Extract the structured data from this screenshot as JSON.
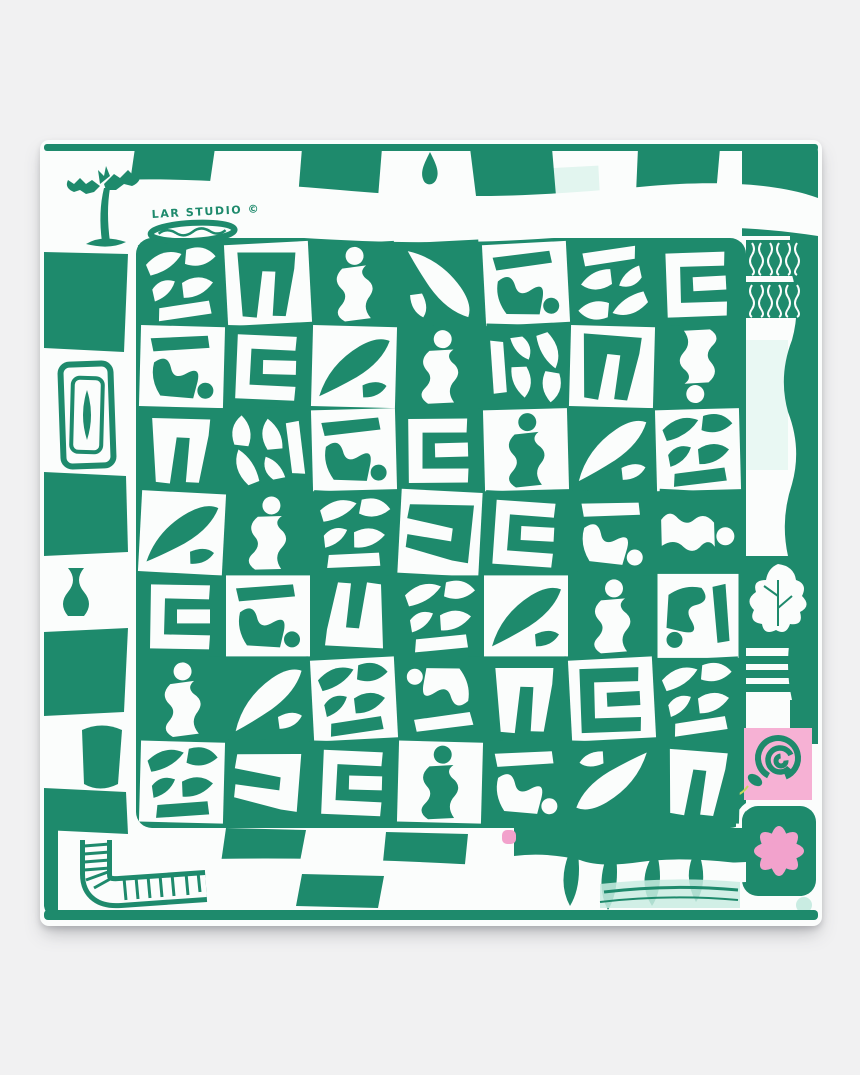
{
  "page": {
    "background_color": "#f1f1f2"
  },
  "scarf": {
    "signature": "LAR STUDIO ©",
    "colors": {
      "green": "#1e8a6c",
      "white": "#fbfdfc",
      "pink": "#f2a2cc",
      "pink_panel": "#f6b1d4",
      "mint": "#c9ece2"
    },
    "motifs": {
      "border": "checkerboard-border",
      "top_left": "palm-tree-icon",
      "top_center": "water-droplet-icon",
      "left": "concentric-frame-icon",
      "top_right": "zebra-stripe-blocks",
      "right_upper": "oak-leaf-icon",
      "right_mid": "stripe-block",
      "right_lower": "coiled-snake-icon",
      "right_bottom": "flower-icon",
      "bottom_left": "curved-ladder-icon",
      "bottom_center": "pink-dot",
      "bottom_right": "mint-dot",
      "center": "abstract-cutout-grid"
    }
  },
  "pattern": {
    "grid_rows": 7,
    "grid_cols": 7,
    "tiles": [
      [
        "1g0",
        "3w0",
        "2g0",
        "5g90",
        "4w0",
        "1g180",
        "6g0"
      ],
      [
        "4w0",
        "6g0",
        "5w0",
        "2g0",
        "1g90",
        "3w0",
        "2g180"
      ],
      [
        "3g0",
        "1g270",
        "4w0",
        "6g0",
        "2w0",
        "5g0",
        "1w0"
      ],
      [
        "5w0",
        "2g0",
        "1g0",
        "3w90",
        "6g0",
        "4g0",
        "2g90"
      ],
      [
        "6g0",
        "4w0",
        "3g180",
        "1g0",
        "5w0",
        "2g0",
        "4w90"
      ],
      [
        "2g0",
        "5g0",
        "1w0",
        "4g180",
        "3g0",
        "6w0",
        "1g0"
      ],
      [
        "1w0",
        "3g90",
        "6g0",
        "2w0",
        "4g0",
        "5g180",
        "3g0"
      ]
    ]
  }
}
